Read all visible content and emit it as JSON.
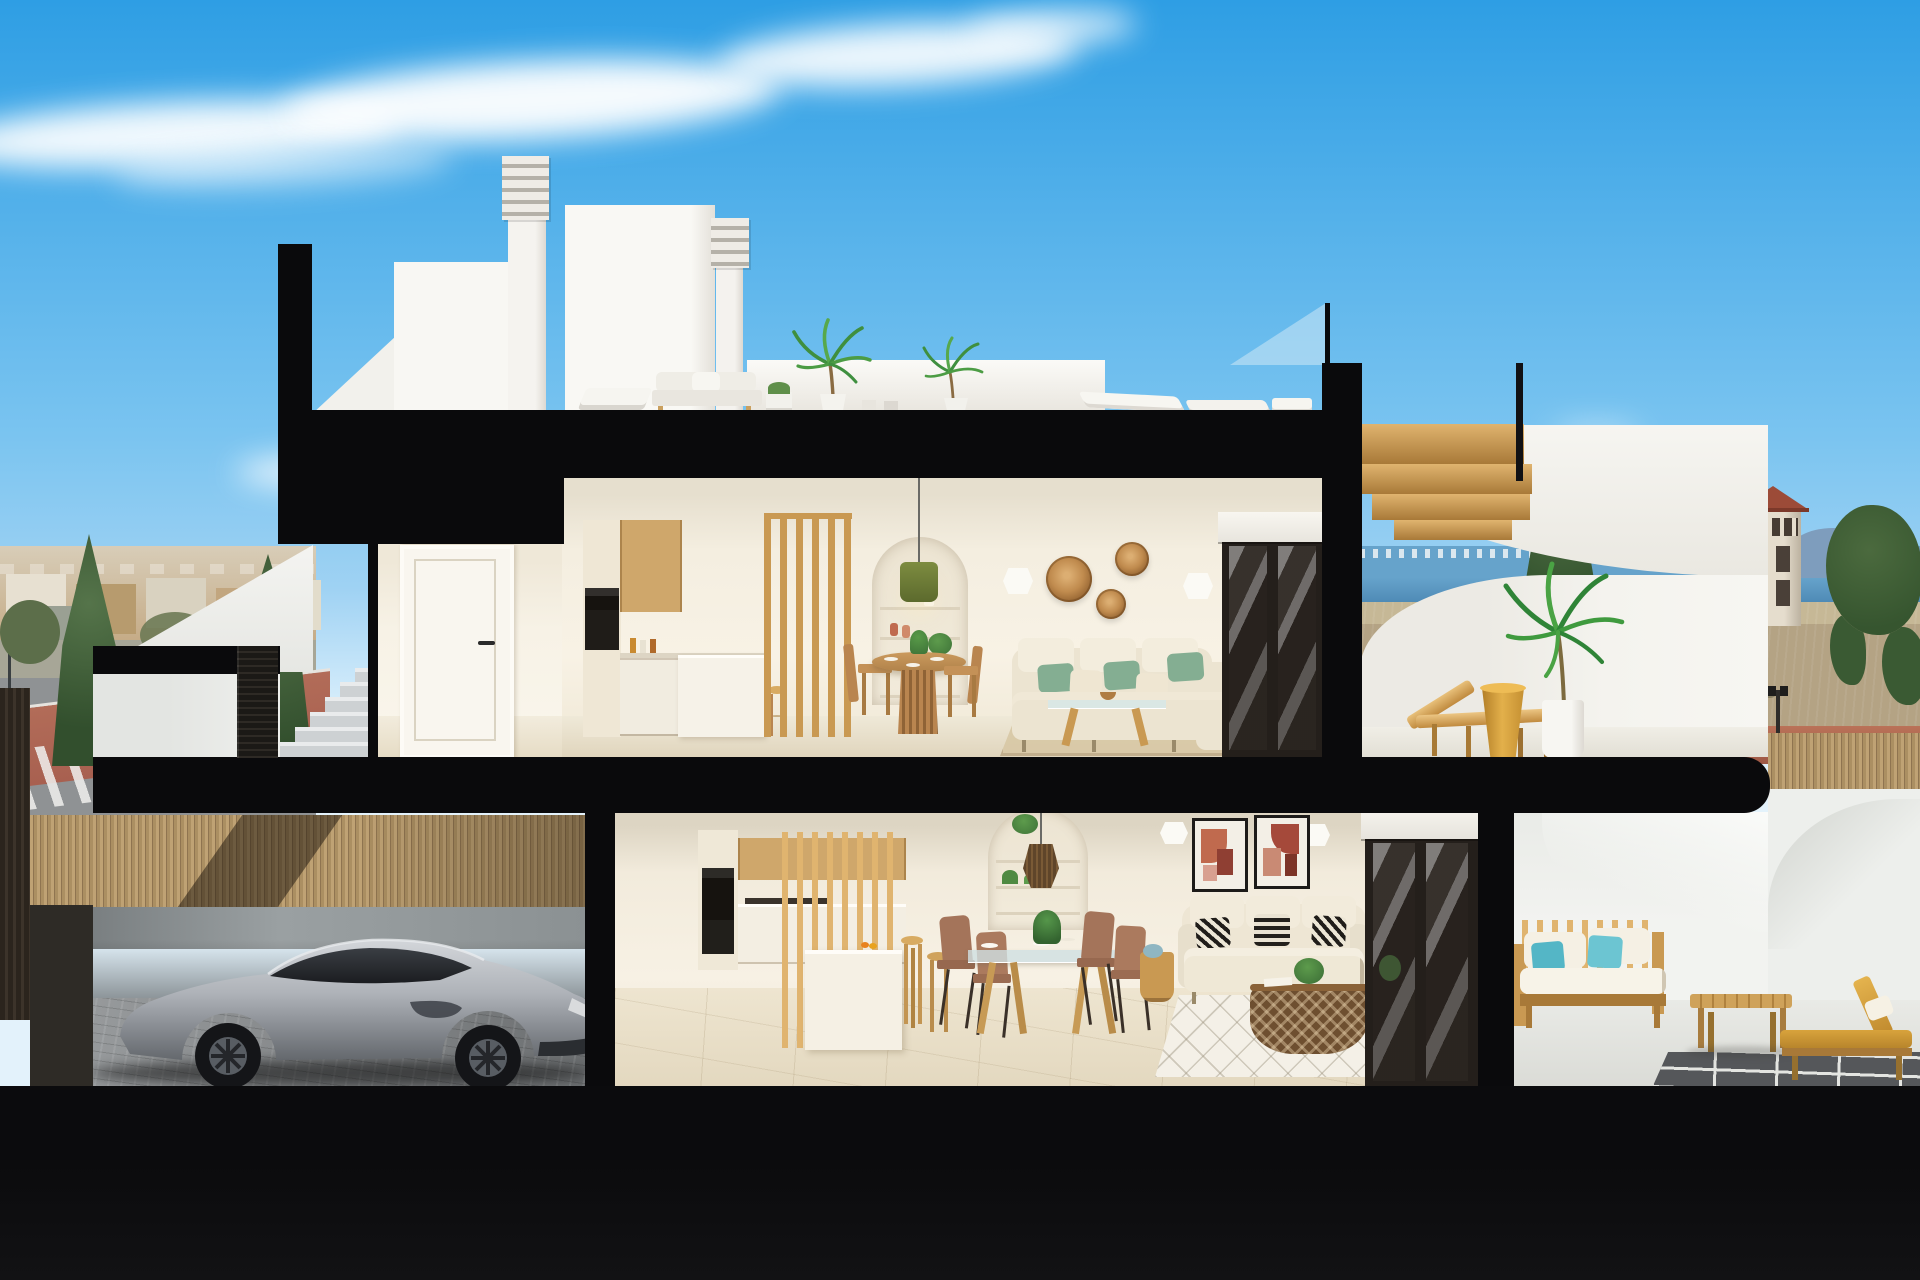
{
  "scene": {
    "type": "3d-architectural-cross-section-render",
    "description": "Daylight cross-section render of a modern two-storey coastal townhouse. Roof: solarium terrace with two louvered chimneys, stair bulkhead, white outdoor lounge furniture, potted palms and a glass railing with a gold timber stair. Upper floor: entry hall with white door, oak kitchen with wood-slat partition, round dining table, arched shelf niche with green pendant lamp, cream sofa with green pillows, rattan wall baskets and sliding glass door to a sun terrace with timber lounger, gold side table and palm. Ground floor: garage with silver sports coupe behind a bamboo fence, second oak kitchen with slat screen and stools, glass dining table with four chairs, arched niche with rattan pendant, cream sofa with patterned pillows, basket coffee table, art prints, and a rear patio with timber sofa, teal pillows, coffee table and gold chaise. Background: wispy clouds, distant town and street with red sidewalk on the left, sea horizon, watchtower, dry fields and trees on the right. Thick black cut slabs outline the section; dark ground base below.",
    "time_of_day": "day"
  },
  "colors": {
    "sky_top": "#2E9EE4",
    "sky_mid": "#7AC4F0",
    "sky_horizon": "#D6EDFB",
    "cloud": "#FFFFFF",
    "cut": "#0A0A0C",
    "base": "#0B0B0D",
    "white_wall": "#F6F5F1",
    "white_shade": "#DEDBD3",
    "cream": "#F4EDDD",
    "cream_dark": "#E2D8C2",
    "ceiling": "#D8D1C0",
    "floor_up": "#EDE5D1",
    "floor_dn": "#E9DFC9",
    "wood": "#C99952",
    "wood_light": "#E0B46F",
    "wood_dark": "#A87938",
    "oak": "#CFA76B",
    "gold_stair": "#D79A2B",
    "oven": "#16130F",
    "frame_dark": "#241F1B",
    "sofa": "#ECE4D1",
    "cushion": "#F3EDDD",
    "pillow_green": "#84AE92",
    "pillow_teal": "#54B6C6",
    "cushion_gold": "#D8A33C",
    "rattan": "#B9854F",
    "rattan_dark": "#6E4F30",
    "glass": "#CFE2E8",
    "rug_up": "#D9C9A7",
    "rug_dn": "#F4F0E7",
    "sea": "#66A3CB",
    "sea_deep": "#4D89B4",
    "town": "#C2A67F",
    "town_light": "#E7E0D1",
    "tree": "#49663C",
    "tree_dark": "#324F2D",
    "road": "#8F9294",
    "red_path": "#A86050",
    "field": "#B4A384",
    "bamboo": "#BFA274",
    "bamboo_dark": "#8F7450",
    "car": "#B7BBC1",
    "car_dark": "#2B2E33",
    "concrete": "#CDD1D3",
    "terracotta": "#C06A4E",
    "pendant_green": "#75843A"
  },
  "rooms": [
    {
      "name": "roof-solarium"
    },
    {
      "name": "upper-entry-hall"
    },
    {
      "name": "upper-kitchen"
    },
    {
      "name": "upper-dining"
    },
    {
      "name": "upper-living"
    },
    {
      "name": "upper-sun-terrace"
    },
    {
      "name": "garage"
    },
    {
      "name": "ground-kitchen"
    },
    {
      "name": "ground-dining"
    },
    {
      "name": "ground-living"
    },
    {
      "name": "rear-patio"
    }
  ],
  "background_features": [
    "sky",
    "clouds",
    "distant-town",
    "street-with-red-sidewalk",
    "sea-horizon",
    "watchtower",
    "dry-fields",
    "trees",
    "bamboo-fence"
  ],
  "vehicle": {
    "type": "sports-coupe",
    "color_name": "silver"
  }
}
